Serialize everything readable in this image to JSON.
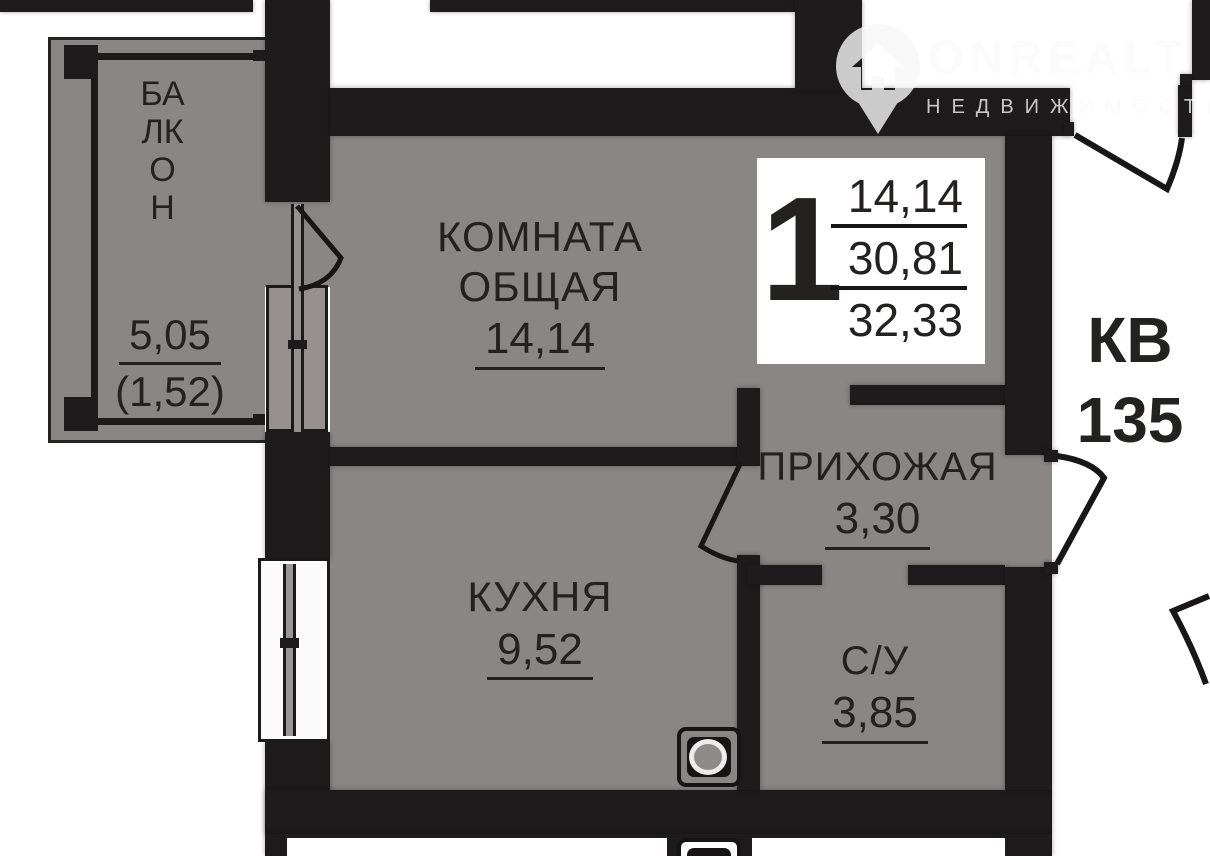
{
  "watermark": {
    "brand": "ONREALT",
    "tagline": "НЕДВИЖИМОСТЬ"
  },
  "badge": {
    "rooms": "1",
    "value_top": "14,14",
    "value_mid": "30,81",
    "value_bottom": "32,33"
  },
  "apartment": {
    "label_line1": "КВ",
    "label_line2": "135"
  },
  "rooms": {
    "balcony": {
      "name": "БАЛКОН",
      "area": "5,05",
      "area_secondary": "(1,52)"
    },
    "living": {
      "name_line1": "КОМНАТА",
      "name_line2": "ОБЩАЯ",
      "area": "14,14"
    },
    "kitchen": {
      "name": "КУХНЯ",
      "area": "9,52"
    },
    "hallway": {
      "name": "ПРИХОЖАЯ",
      "area": "3,30"
    },
    "bathroom": {
      "name": "С/У",
      "area": "3,85"
    }
  },
  "colors": {
    "floor": "#8b8686",
    "wall": "#1d1b1b",
    "text": "#242121",
    "badge_bg": "#ffffff"
  }
}
